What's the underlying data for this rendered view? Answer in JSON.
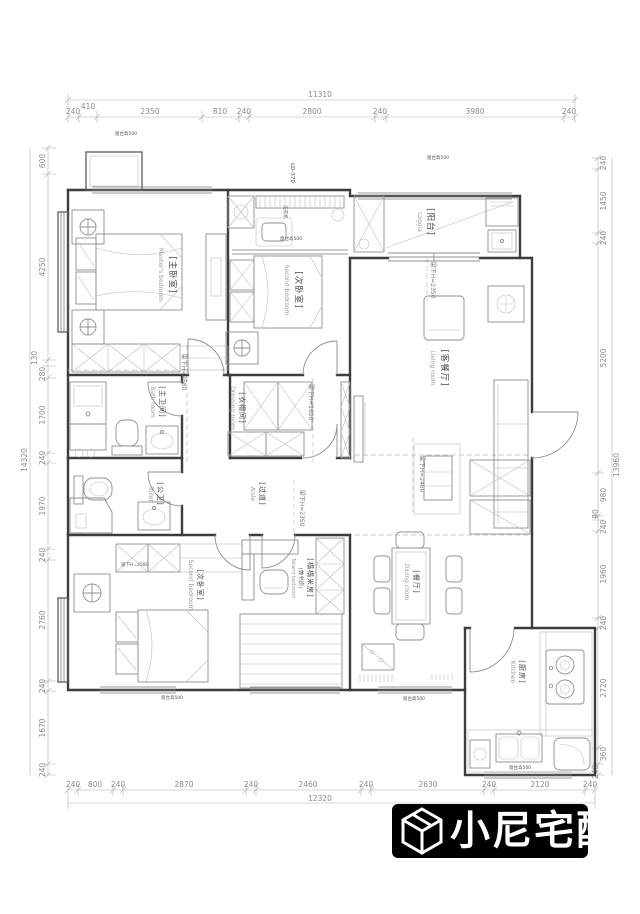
{
  "dims": {
    "top": {
      "total": "11310",
      "segments": [
        "240",
        "410",
        "2350",
        "810",
        "240",
        "2800",
        "240",
        "3980",
        "240"
      ]
    },
    "bottom": {
      "total": "12320",
      "segments": [
        "240",
        "800",
        "240",
        "2870",
        "240",
        "2460",
        "240",
        "2630",
        "240",
        "2120",
        "240"
      ]
    },
    "left": {
      "total": "14320",
      "segments": [
        "600",
        "4250",
        "130",
        "280",
        "1700",
        "240",
        "1970",
        "240",
        "2760",
        "240",
        "1670",
        "240"
      ]
    },
    "right": {
      "total": "13960",
      "segments": [
        "240",
        "1450",
        "240",
        "5200",
        "980",
        "90",
        "240",
        "1960",
        "240",
        "2720",
        "360",
        "240"
      ]
    }
  },
  "rooms": [
    {
      "cn": "[主卧室]",
      "en": "Master's bedroom"
    },
    {
      "cn": "[次卧室]",
      "en": "Second bedroom"
    },
    {
      "cn": "[阳台]",
      "en": "Loggia"
    },
    {
      "cn": "[客餐厅]",
      "en": "Living room"
    },
    {
      "cn": "[主卫间]",
      "en": "Bath room"
    },
    {
      "cn": "[公卫]",
      "en": "Toilet"
    },
    {
      "cn": "[衣帽间]",
      "en": "Dressing room"
    },
    {
      "cn": "[过道]",
      "en": "Aisle"
    },
    {
      "cn": "[次卧室]",
      "en": "Second bedroom"
    },
    {
      "cn": "[榻榻米房]",
      "sub": "(兼书房)",
      "en": "Tatami bedroom"
    },
    {
      "cn": "[餐厅]",
      "en": "Dining room"
    },
    {
      "cn": "[厨房]",
      "en": "Kitchen"
    }
  ],
  "beams": {
    "h2580": "梁下H=2580",
    "h2620": "梁下H=2620",
    "h2350": "梁下H=2350",
    "h2460": "梁下H=2460"
  },
  "annotations": {
    "washer": "洗衣机",
    "sill": "窗台高500",
    "ld": "LD-370"
  },
  "brand": {
    "name": "小尼宅配",
    "bg": "#000000",
    "fg": "#ffffff"
  }
}
